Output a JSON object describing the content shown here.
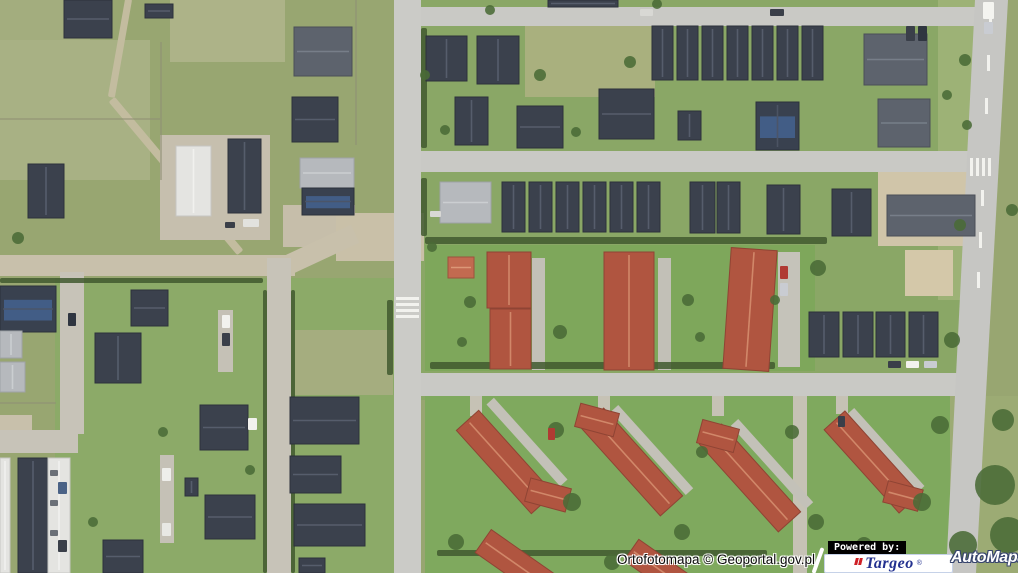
{
  "branding": {
    "attribution": "Ortofotomapa © Geoportal.gov.pl",
    "powered_by": "Powered by:",
    "targeo_name": "Targeo",
    "automapa_name": "AutoMapa",
    "registered_mark": "®",
    "targeo_text_color": "#23318f",
    "targeo_glyph_color": "#cf2027",
    "automapa_text_color": "#ffffff",
    "automapa_outline_color": "#39466e"
  },
  "map": {
    "width": 1018,
    "height": 573,
    "palette": {
      "base": "#98a671",
      "marking": "#f2f2ee",
      "hedge": "#41592f",
      "fence": "#8f8f74",
      "tree": "#4a6b37",
      "solar_panel": "#44618c",
      "roof": {
        "d": {
          "f": "#3b414d",
          "s": "#2c313b",
          "r": "#5a6170"
        },
        "s": {
          "f": "#5d636d",
          "s": "#4a4f58",
          "r": "#7a828d"
        },
        "g": {
          "f": "#b6b9bd",
          "s": "#9fa2a6",
          "r": "#ced1d4"
        },
        "w": {
          "f": "#e4e4e1",
          "s": "#c6c6c2",
          "r": "#f3f3f0"
        },
        "r": {
          "f": "#b05540",
          "s": "#8f4434",
          "r": "#d58d6e"
        },
        "o": {
          "f": "#c26a50",
          "s": "#9c523c",
          "r": "#df9c7c"
        },
        "sol": {
          "f": "#39414f",
          "s": "#2c313b",
          "r": "#4d5566"
        }
      }
    },
    "zones": [
      [
        421,
        0,
        560,
        400,
        "#8aa766"
      ],
      [
        55,
        278,
        340,
        295,
        "#8caa68"
      ],
      [
        0,
        0,
        90,
        60,
        "#a3ad7e"
      ],
      [
        170,
        0,
        115,
        62,
        "#adb388"
      ],
      [
        0,
        40,
        150,
        140,
        "#a8b184"
      ],
      [
        525,
        25,
        130,
        72,
        "#a9b07e"
      ],
      [
        930,
        396,
        88,
        177,
        "#9cab74"
      ],
      [
        938,
        0,
        40,
        300,
        "#9db276"
      ],
      [
        425,
        245,
        390,
        126,
        "#7ea75b"
      ],
      [
        425,
        396,
        525,
        177,
        "#7fa95e"
      ],
      [
        295,
        330,
        98,
        65,
        "#a5ad7f"
      ]
    ],
    "dirt_paths": [
      [
        120,
        48,
        7,
        100,
        10,
        "#c3bc9f"
      ],
      [
        176,
        176,
        8,
        200,
        -40,
        "#c3bc9f"
      ]
    ],
    "pads": [
      [
        160,
        135,
        110,
        105,
        "#c6bfae"
      ],
      [
        283,
        205,
        72,
        42,
        "#c6beaa"
      ],
      [
        336,
        213,
        88,
        48,
        "#c9c0a8"
      ],
      [
        878,
        158,
        100,
        88,
        "#d0c5a9"
      ],
      [
        905,
        250,
        48,
        46,
        "#d4c8a9"
      ],
      [
        0,
        415,
        32,
        22,
        "#c8c0ab"
      ],
      [
        160,
        455,
        14,
        88,
        "#c5c1b6"
      ],
      [
        218,
        310,
        15,
        62,
        "#c5c1b6"
      ],
      [
        532,
        258,
        13,
        112,
        "#c2c0b7"
      ],
      [
        658,
        258,
        13,
        112,
        "#c2c0b7"
      ],
      [
        778,
        252,
        22,
        115,
        "#c5c3ba"
      ],
      [
        793,
        396,
        14,
        177,
        "#c6c2b5"
      ],
      [
        470,
        396,
        12,
        20,
        "#c6c2b5"
      ],
      [
        598,
        396,
        12,
        18,
        "#c6c2b5"
      ],
      [
        712,
        396,
        12,
        20,
        "#c6c2b5"
      ],
      [
        836,
        396,
        12,
        18,
        "#c6c2b5"
      ]
    ],
    "rpads": [
      [
        527,
        442,
        10,
        110,
        -42,
        "#c3c1b8"
      ],
      [
        652,
        450,
        10,
        112,
        -42,
        "#c3c1b8"
      ],
      [
        772,
        464,
        10,
        112,
        -42,
        "#c3c1b8"
      ],
      [
        886,
        450,
        9,
        105,
        -42,
        "#c3c1b8"
      ],
      [
        318,
        251,
        20,
        82,
        65,
        "#c8c0ab"
      ]
    ],
    "roads": {
      "rects": [
        [
          394,
          0,
          27,
          573,
          "#cbcbc7"
        ],
        [
          421,
          7,
          554,
          19,
          "#c9c9c5"
        ],
        [
          421,
          151,
          549,
          21,
          "#c9c9c5"
        ],
        [
          421,
          373,
          541,
          23,
          "#c9c9c5"
        ],
        [
          0,
          255,
          295,
          21,
          "#c8c0ab"
        ],
        [
          267,
          258,
          24,
          315,
          "#c7c3b8"
        ],
        [
          60,
          272,
          24,
          162,
          "#c7c3b8"
        ],
        [
          0,
          430,
          78,
          23,
          "#c7c3b8"
        ]
      ],
      "polys": [
        [
          "975,0 1008,0 976,573 946,573",
          "#c6c6c3"
        ]
      ]
    },
    "stripes": [
      [
        396,
        297,
        23,
        3
      ],
      [
        396,
        303,
        23,
        3
      ],
      [
        396,
        309,
        23,
        3
      ],
      [
        396,
        315,
        23,
        3
      ],
      [
        970,
        158,
        3,
        18
      ],
      [
        976,
        158,
        3,
        18
      ],
      [
        982,
        158,
        3,
        18
      ],
      [
        988,
        158,
        3,
        18
      ],
      [
        989,
        15,
        3,
        16
      ],
      [
        987,
        55,
        3,
        16
      ],
      [
        985,
        98,
        3,
        16
      ],
      [
        981,
        190,
        3,
        16
      ],
      [
        979,
        232,
        3,
        16
      ],
      [
        977,
        272,
        3,
        16
      ]
    ],
    "hedges": [
      [
        425,
        237,
        402,
        7
      ],
      [
        421,
        28,
        6,
        120
      ],
      [
        421,
        178,
        6,
        58
      ],
      [
        430,
        362,
        345,
        7
      ],
      [
        263,
        290,
        4,
        283
      ],
      [
        291,
        290,
        4,
        283
      ],
      [
        387,
        300,
        6,
        75
      ],
      [
        437,
        550,
        330,
        6
      ],
      [
        0,
        278,
        263,
        5
      ]
    ],
    "fences": [
      [
        0,
        118,
        160,
        2
      ],
      [
        160,
        42,
        2,
        138
      ],
      [
        355,
        0,
        2,
        145
      ],
      [
        0,
        402,
        56,
        2
      ]
    ],
    "buildings": [
      [
        64,
        0,
        48,
        38,
        "d"
      ],
      [
        145,
        4,
        28,
        14,
        "d"
      ],
      [
        294,
        27,
        58,
        49,
        "s"
      ],
      [
        292,
        97,
        46,
        45,
        "d"
      ],
      [
        28,
        164,
        36,
        54,
        "d"
      ],
      [
        176,
        146,
        35,
        70,
        "w"
      ],
      [
        228,
        139,
        33,
        74,
        "d"
      ],
      [
        300,
        158,
        54,
        30,
        "g"
      ],
      [
        302,
        188,
        52,
        27,
        "sol"
      ],
      [
        426,
        36,
        41,
        45,
        "d"
      ],
      [
        477,
        36,
        42,
        48,
        "d"
      ],
      [
        548,
        0,
        70,
        7,
        "d"
      ],
      [
        652,
        26,
        21,
        54,
        "d"
      ],
      [
        677,
        26,
        21,
        54,
        "d"
      ],
      [
        702,
        26,
        21,
        54,
        "d"
      ],
      [
        727,
        26,
        21,
        54,
        "d"
      ],
      [
        752,
        26,
        21,
        54,
        "d"
      ],
      [
        777,
        26,
        21,
        54,
        "d"
      ],
      [
        802,
        26,
        21,
        54,
        "d"
      ],
      [
        864,
        34,
        63,
        51,
        "s"
      ],
      [
        455,
        97,
        33,
        48,
        "d"
      ],
      [
        517,
        106,
        46,
        42,
        "d"
      ],
      [
        599,
        89,
        55,
        50,
        "d"
      ],
      [
        678,
        111,
        23,
        29,
        "d"
      ],
      [
        756,
        102,
        43,
        48,
        "sol"
      ],
      [
        878,
        99,
        52,
        48,
        "s"
      ],
      [
        440,
        182,
        51,
        41,
        "g"
      ],
      [
        502,
        182,
        23,
        50,
        "d"
      ],
      [
        529,
        182,
        23,
        50,
        "d"
      ],
      [
        556,
        182,
        23,
        50,
        "d"
      ],
      [
        583,
        182,
        23,
        50,
        "d"
      ],
      [
        610,
        182,
        23,
        50,
        "d"
      ],
      [
        637,
        182,
        23,
        50,
        "d"
      ],
      [
        690,
        182,
        25,
        51,
        "d"
      ],
      [
        717,
        182,
        23,
        51,
        "d"
      ],
      [
        767,
        185,
        33,
        49,
        "d"
      ],
      [
        832,
        189,
        39,
        47,
        "d"
      ],
      [
        887,
        195,
        88,
        41,
        "s"
      ],
      [
        448,
        257,
        26,
        21,
        "o"
      ],
      [
        487,
        252,
        44,
        56,
        "r"
      ],
      [
        490,
        309,
        41,
        60,
        "r"
      ],
      [
        604,
        252,
        50,
        118,
        "r"
      ],
      [
        727,
        249,
        46,
        121,
        "r",
        4
      ],
      [
        809,
        312,
        30,
        45,
        "d"
      ],
      [
        843,
        312,
        30,
        45,
        "d"
      ],
      [
        876,
        312,
        29,
        45,
        "d"
      ],
      [
        909,
        312,
        29,
        45,
        "d"
      ],
      [
        0,
        286,
        56,
        46,
        "sol"
      ],
      [
        95,
        333,
        46,
        50,
        "d"
      ],
      [
        131,
        290,
        37,
        36,
        "d"
      ],
      [
        0,
        331,
        22,
        27,
        "g"
      ],
      [
        0,
        362,
        25,
        30,
        "g"
      ],
      [
        18,
        458,
        30,
        115,
        "d"
      ],
      [
        48,
        458,
        22,
        115,
        "w"
      ],
      [
        0,
        458,
        10,
        115,
        "w"
      ],
      [
        200,
        405,
        48,
        45,
        "d"
      ],
      [
        205,
        495,
        50,
        44,
        "d"
      ],
      [
        185,
        478,
        13,
        18,
        "d"
      ],
      [
        103,
        540,
        40,
        33,
        "d"
      ],
      [
        290,
        397,
        69,
        47,
        "d"
      ],
      [
        290,
        456,
        51,
        37,
        "d"
      ],
      [
        294,
        504,
        71,
        42,
        "d"
      ],
      [
        299,
        558,
        26,
        15,
        "d"
      ],
      [
        490,
        406,
        30,
        112,
        "r",
        -42
      ],
      [
        536,
        474,
        24,
        42,
        "r",
        -75
      ],
      [
        617,
        403,
        30,
        118,
        "r",
        -42
      ],
      [
        585,
        400,
        24,
        40,
        "r",
        -75
      ],
      [
        735,
        419,
        30,
        118,
        "r",
        -42
      ],
      [
        706,
        417,
        24,
        38,
        "r",
        -75
      ],
      [
        858,
        406,
        28,
        112,
        "r",
        -42
      ],
      [
        892,
        478,
        22,
        36,
        "r",
        -75
      ],
      [
        502,
        524,
        28,
        80,
        "r",
        -55
      ],
      [
        647,
        535,
        26,
        70,
        "r",
        -55
      ]
    ],
    "trees": [
      [
        995,
        485,
        20
      ],
      [
        1008,
        535,
        18
      ],
      [
        963,
        545,
        14
      ],
      [
        940,
        425,
        9
      ],
      [
        1003,
        420,
        11
      ],
      [
        952,
        340,
        8
      ],
      [
        965,
        60,
        6
      ],
      [
        967,
        125,
        5
      ],
      [
        960,
        225,
        6
      ],
      [
        947,
        95,
        5
      ],
      [
        1012,
        210,
        6
      ],
      [
        470,
        302,
        6
      ],
      [
        560,
        332,
        7
      ],
      [
        688,
        300,
        6
      ],
      [
        700,
        337,
        5
      ],
      [
        818,
        268,
        8
      ],
      [
        462,
        342,
        5
      ],
      [
        775,
        300,
        5
      ],
      [
        556,
        430,
        8
      ],
      [
        572,
        502,
        9
      ],
      [
        682,
        532,
        8
      ],
      [
        702,
        452,
        6
      ],
      [
        792,
        432,
        7
      ],
      [
        816,
        522,
        8
      ],
      [
        922,
        502,
        9
      ],
      [
        456,
        542,
        8
      ],
      [
        612,
        562,
        8
      ],
      [
        748,
        560,
        7
      ],
      [
        864,
        545,
        8
      ],
      [
        18,
        238,
        6
      ],
      [
        163,
        432,
        5
      ],
      [
        93,
        522,
        5
      ],
      [
        250,
        470,
        5
      ],
      [
        630,
        62,
        6
      ],
      [
        576,
        132,
        5
      ],
      [
        657,
        4,
        5
      ],
      [
        432,
        247,
        5
      ],
      [
        445,
        130,
        5
      ],
      [
        425,
        75,
        5
      ],
      [
        490,
        10,
        5
      ],
      [
        540,
        75,
        6
      ]
    ],
    "cars": [
      [
        906,
        26,
        9,
        15,
        "#3a3f49"
      ],
      [
        918,
        26,
        9,
        15,
        "#2f3540"
      ],
      [
        983,
        2,
        11,
        17,
        "#f4f4f0"
      ],
      [
        984,
        22,
        9,
        12,
        "#c9ccd2"
      ],
      [
        222,
        315,
        8,
        13,
        "#f2f2ee"
      ],
      [
        222,
        333,
        8,
        13,
        "#3a3f49"
      ],
      [
        162,
        468,
        9,
        13,
        "#eeeeea"
      ],
      [
        162,
        523,
        9,
        13,
        "#e8e8e4"
      ],
      [
        68,
        313,
        8,
        13,
        "#2f3540"
      ],
      [
        780,
        266,
        8,
        13,
        "#b03a33"
      ],
      [
        780,
        283,
        8,
        13,
        "#c9ccd2"
      ],
      [
        888,
        361,
        13,
        7,
        "#3a3f49"
      ],
      [
        906,
        361,
        13,
        7,
        "#f2f2ee"
      ],
      [
        924,
        361,
        13,
        7,
        "#c9ccd2"
      ],
      [
        548,
        428,
        7,
        12,
        "#b03a33"
      ],
      [
        838,
        416,
        7,
        11,
        "#3a3f49"
      ],
      [
        248,
        418,
        9,
        12,
        "#f2f2ee"
      ],
      [
        430,
        211,
        11,
        6,
        "#d8d8d4"
      ],
      [
        243,
        219,
        16,
        8,
        "#e2e2de"
      ],
      [
        225,
        222,
        10,
        6,
        "#3a3f49"
      ],
      [
        770,
        9,
        14,
        7,
        "#3a3f49"
      ],
      [
        640,
        9,
        13,
        7,
        "#d8d8d4"
      ],
      [
        50,
        470,
        8,
        6,
        "#6b7078"
      ],
      [
        50,
        500,
        8,
        6,
        "#6b7078"
      ],
      [
        50,
        530,
        8,
        6,
        "#6b7078"
      ],
      [
        58,
        482,
        9,
        12,
        "#4a6286"
      ],
      [
        58,
        540,
        9,
        12,
        "#3a3f49"
      ]
    ]
  }
}
